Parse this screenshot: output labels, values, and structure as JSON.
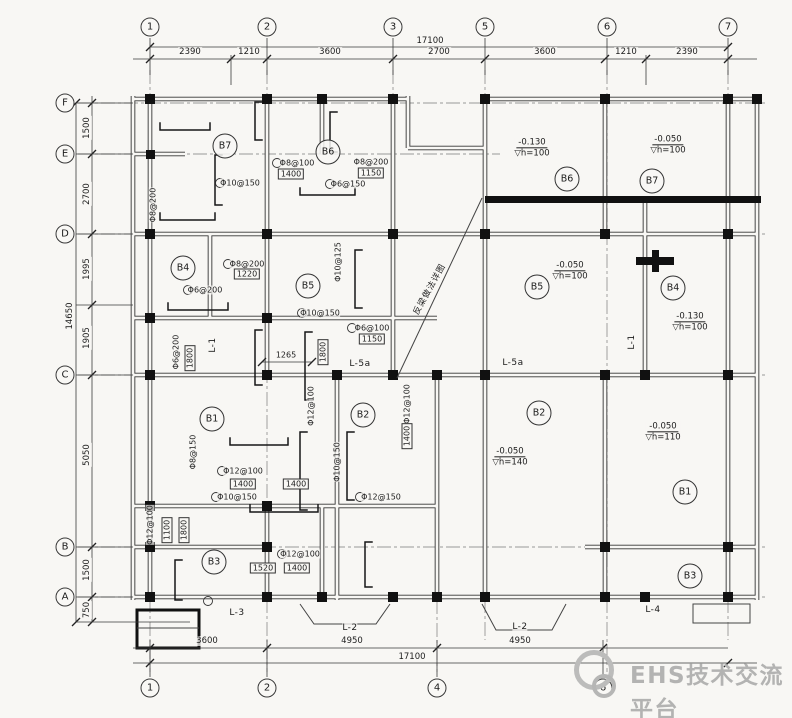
{
  "drawing": {
    "watermark": {
      "text": "EHS技术交流平台"
    },
    "grid": {
      "top": [
        {
          "label": "1",
          "x": 150
        },
        {
          "label": "2",
          "x": 267
        },
        {
          "label": "3",
          "x": 393
        },
        {
          "label": "5",
          "x": 485
        },
        {
          "label": "6",
          "x": 607
        },
        {
          "label": "7",
          "x": 728
        }
      ],
      "bottom": [
        {
          "label": "1",
          "x": 150
        },
        {
          "label": "2",
          "x": 267
        },
        {
          "label": "4",
          "x": 437
        },
        {
          "label": "6",
          "x": 603
        }
      ],
      "left": [
        {
          "label": "F",
          "y": 103
        },
        {
          "label": "E",
          "y": 154
        },
        {
          "label": "D",
          "y": 234
        },
        {
          "label": "C",
          "y": 375
        },
        {
          "label": "B",
          "y": 547
        },
        {
          "label": "A",
          "y": 597
        }
      ]
    },
    "dims": {
      "top_total": {
        "label": "17100",
        "x": 430,
        "y": 41
      },
      "top_segs_y": 52,
      "top_segs": [
        {
          "label": "2390",
          "x": 190
        },
        {
          "label": "1210",
          "x": 249
        },
        {
          "label": "3600",
          "x": 330
        },
        {
          "label": "2700",
          "x": 439
        },
        {
          "label": "3600",
          "x": 545
        },
        {
          "label": "1210",
          "x": 626
        },
        {
          "label": "2390",
          "x": 687
        }
      ],
      "left_total": {
        "label": "14650",
        "x": 70,
        "y": 316
      },
      "left_segs_x": 87,
      "left_segs": [
        {
          "label": "1500",
          "y": 128
        },
        {
          "label": "2700",
          "y": 194
        },
        {
          "label": "1995",
          "y": 269
        },
        {
          "label": "1905",
          "y": 338
        },
        {
          "label": "5050",
          "y": 455
        },
        {
          "label": "1500",
          "y": 570
        },
        {
          "label": "750",
          "y": 610
        }
      ],
      "bottom_segs_y": 641,
      "bottom_segs": [
        {
          "label": "3600",
          "x": 207
        },
        {
          "label": "4950",
          "x": 352
        },
        {
          "label": "4950",
          "x": 520
        }
      ],
      "bottom_total": {
        "label": "17100",
        "x": 412,
        "y": 657
      }
    },
    "rooms": [
      {
        "label": "B7",
        "x": 225,
        "y": 146
      },
      {
        "label": "B6",
        "x": 328,
        "y": 152
      },
      {
        "label": "B4",
        "x": 183,
        "y": 268
      },
      {
        "label": "B5",
        "x": 308,
        "y": 286
      },
      {
        "label": "B1",
        "x": 212,
        "y": 419
      },
      {
        "label": "B2",
        "x": 363,
        "y": 415
      },
      {
        "label": "B3",
        "x": 214,
        "y": 562
      },
      {
        "label": "B6",
        "x": 567,
        "y": 179
      },
      {
        "label": "B7",
        "x": 652,
        "y": 181
      },
      {
        "label": "B5",
        "x": 537,
        "y": 287
      },
      {
        "label": "B4",
        "x": 673,
        "y": 288
      },
      {
        "label": "B2",
        "x": 539,
        "y": 413
      },
      {
        "label": "B1",
        "x": 685,
        "y": 492
      },
      {
        "label": "B3",
        "x": 690,
        "y": 576
      }
    ],
    "levels": [
      {
        "value": "-0.130",
        "note": "h=100",
        "x": 532,
        "y": 148
      },
      {
        "value": "-0.050",
        "note": "h=100",
        "x": 668,
        "y": 145
      },
      {
        "value": "-0.050",
        "note": "h=100",
        "x": 570,
        "y": 271
      },
      {
        "value": "-0.130",
        "note": "h=100",
        "x": 690,
        "y": 322
      },
      {
        "value": "-0.050",
        "note": "h=140",
        "x": 510,
        "y": 457
      },
      {
        "value": "-0.050",
        "note": "h=110",
        "x": 663,
        "y": 432
      }
    ],
    "beams": [
      {
        "label": "L-1",
        "x": 213,
        "y": 345,
        "vertical": true
      },
      {
        "label": "L-1",
        "x": 632,
        "y": 342,
        "vertical": true
      },
      {
        "label": "L-5a",
        "x": 360,
        "y": 364,
        "vertical": false
      },
      {
        "label": "L-5a",
        "x": 513,
        "y": 363,
        "vertical": false
      },
      {
        "label": "L-3",
        "x": 237,
        "y": 613,
        "vertical": false
      },
      {
        "label": "L-2",
        "x": 350,
        "y": 628,
        "vertical": false
      },
      {
        "label": "L-2",
        "x": 520,
        "y": 627,
        "vertical": false
      },
      {
        "label": "L-4",
        "x": 653,
        "y": 610,
        "vertical": false
      }
    ],
    "callouts": [
      {
        "text": "Φ10@150",
        "x": 240,
        "y": 183
      },
      {
        "text": "Φ8@100",
        "x": 297,
        "y": 163
      },
      {
        "text": "1400",
        "x": 291,
        "y": 174,
        "boxed": true
      },
      {
        "text": "Φ8@200",
        "x": 371,
        "y": 162
      },
      {
        "text": "1150",
        "x": 371,
        "y": 173,
        "boxed": true
      },
      {
        "text": "Φ6@150",
        "x": 348,
        "y": 184
      },
      {
        "text": "Φ8@200",
        "x": 247,
        "y": 264
      },
      {
        "text": "1220",
        "x": 247,
        "y": 274,
        "boxed": true
      },
      {
        "text": "Φ6@200",
        "x": 205,
        "y": 290
      },
      {
        "text": "Φ10@125",
        "x": 338,
        "y": 262,
        "vertical": true
      },
      {
        "text": "Φ10@150",
        "x": 320,
        "y": 313
      },
      {
        "text": "Φ6@100",
        "x": 372,
        "y": 328
      },
      {
        "text": "1150",
        "x": 372,
        "y": 339,
        "boxed": true
      },
      {
        "text": "1265",
        "x": 286,
        "y": 355
      },
      {
        "text": "1800",
        "x": 323,
        "y": 352,
        "vertical": true,
        "boxed": true
      },
      {
        "text": "Φ8@150",
        "x": 193,
        "y": 452,
        "vertical": true
      },
      {
        "text": "Φ12@100",
        "x": 243,
        "y": 471
      },
      {
        "text": "1400",
        "x": 243,
        "y": 484,
        "boxed": true
      },
      {
        "text": "1400",
        "x": 296,
        "y": 484,
        "boxed": true
      },
      {
        "text": "Φ10@150",
        "x": 237,
        "y": 497
      },
      {
        "text": "Φ10@150",
        "x": 337,
        "y": 462,
        "vertical": true
      },
      {
        "text": "Φ12@150",
        "x": 381,
        "y": 497
      },
      {
        "text": "Φ12@100",
        "x": 300,
        "y": 554
      },
      {
        "text": "1520",
        "x": 263,
        "y": 568,
        "boxed": true
      },
      {
        "text": "1400",
        "x": 297,
        "y": 568,
        "boxed": true
      },
      {
        "text": "Φ12@100",
        "x": 407,
        "y": 404,
        "vertical": true
      },
      {
        "text": "1400",
        "x": 407,
        "y": 436,
        "vertical": true,
        "boxed": true
      },
      {
        "text": "Φ8@200",
        "x": 153,
        "y": 205,
        "vertical": true
      },
      {
        "text": "Φ6@200",
        "x": 176,
        "y": 352,
        "vertical": true
      },
      {
        "text": "1800",
        "x": 190,
        "y": 358,
        "vertical": true,
        "boxed": true
      },
      {
        "text": "Φ12@100",
        "x": 150,
        "y": 525,
        "vertical": true
      },
      {
        "text": "1100",
        "x": 167,
        "y": 530,
        "vertical": true,
        "boxed": true
      },
      {
        "text": "1800",
        "x": 184,
        "y": 530,
        "vertical": true,
        "boxed": true
      },
      {
        "text": "Φ12@100",
        "x": 311,
        "y": 406,
        "vertical": true
      }
    ],
    "note": {
      "text": "反梁做法详图",
      "x": 429,
      "y": 289,
      "rotate": -61
    }
  }
}
